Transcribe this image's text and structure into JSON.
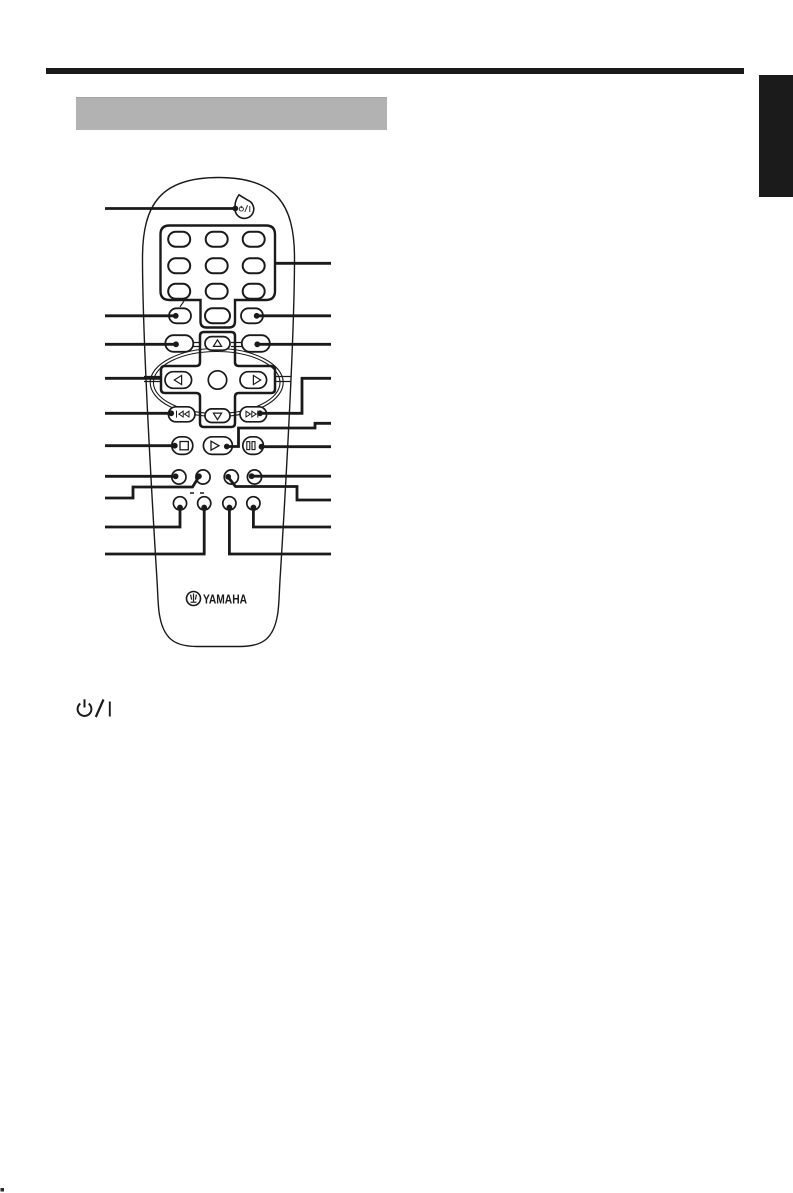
{
  "page": {
    "background": "#ffffff",
    "ink_color": "#1a1a1a",
    "top_rule_color": "#1a1a1a",
    "side_tab_color": "#1b1b1b"
  },
  "section_header": {
    "title_box_label": "",
    "title_box_color": "#b2b2b2"
  },
  "remote": {
    "brand": "YAMAHA",
    "power_button_symbol": "⏻/I",
    "icons": {
      "power": "power-standby-icon",
      "up": "triangle-up-icon",
      "down": "triangle-down-icon",
      "left": "triangle-left-icon",
      "right": "triangle-right-icon",
      "skip_back": "skip-back-icon",
      "skip_forward": "skip-forward-icon",
      "stop": "stop-icon",
      "play": "play-icon",
      "pause": "pause-icon",
      "brand_mark": "yamaha-tuning-fork-icon"
    }
  },
  "legend": {
    "power_symbol": "⏻/I"
  },
  "footer": {
    "corner_mark": "."
  }
}
